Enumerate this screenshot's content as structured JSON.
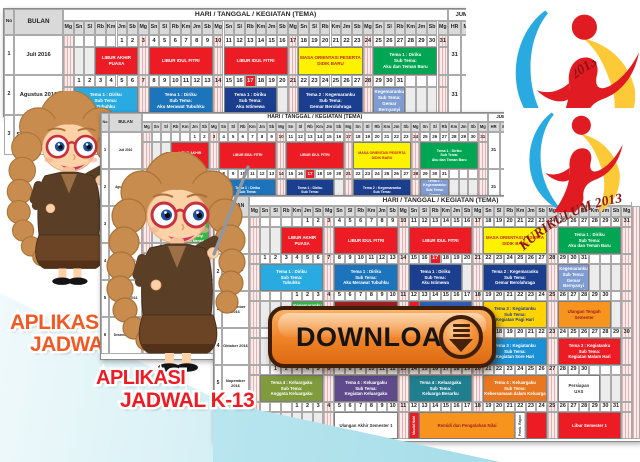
{
  "calendar": {
    "no_label": "No",
    "bulan_label": "BULAN",
    "title": "HARI / TANGGAL / KEGIATAN (TEMA)",
    "jumlah_label": "JUMLAH",
    "jumlah_cols": [
      "HR",
      "MG",
      "HE"
    ],
    "days": [
      "Mg",
      "Sn",
      "Sl",
      "Rb",
      "Km",
      "Jm",
      "Sb"
    ],
    "months": [
      {
        "no": "1",
        "name": "Juli 2016",
        "start_col": 6,
        "days": 31,
        "hr": "31",
        "mg": "5",
        "holiday_cols": [],
        "events": [
          {
            "c0": 4,
            "c1": 7,
            "bg": "#ed1c24",
            "fg": "#ffffff",
            "lines": [
              "LIBUR AKHIR",
              "PUASA"
            ]
          },
          {
            "c0": 9,
            "c1": 14,
            "bg": "#ed1c24",
            "fg": "#ffffff",
            "lines": [
              "LIBUR IDUL FITRI"
            ]
          },
          {
            "c0": 16,
            "c1": 21,
            "bg": "#ed1c24",
            "fg": "#ffffff",
            "lines": [
              "LIBUR IDUL FITRI"
            ]
          },
          {
            "c0": 23,
            "c1": 28,
            "bg": "#fff200",
            "fg": "#c1272d",
            "lines": [
              "MASA ORIENTASI PESERTA",
              "DIDIK BARU"
            ]
          },
          {
            "c0": 30,
            "c1": 35,
            "bg": "#00a651",
            "fg": "#ffffff",
            "lines": [
              "Tema 1 : Diriku",
              "Sub Tema:",
              "Aku dan Teman Baru"
            ]
          }
        ]
      },
      {
        "no": "2",
        "name": "Agustus 2016",
        "start_col": 2,
        "days": 31,
        "hr": "31",
        "mg": "4",
        "holiday_cols": [
          18
        ],
        "events": [
          {
            "c0": 2,
            "c1": 7,
            "bg": "#29abe2",
            "fg": "#ffffff",
            "lines": [
              "Tema 1 : Diriku",
              "Sub Tema:",
              "Tubuhku"
            ]
          },
          {
            "c0": 9,
            "c1": 14,
            "bg": "#1c75bc",
            "fg": "#ffffff",
            "lines": [
              "Tema 1 : Diriku",
              "Sub Tema:",
              "Aku Merawat Tubuhku"
            ]
          },
          {
            "c0": 16,
            "c1": 20,
            "bg": "#1b3e8f",
            "fg": "#ffffff",
            "lines": [
              "Tema 1 : Diriku",
              "Sub Tema:",
              "Aku Istimewa"
            ]
          },
          {
            "c0": 23,
            "c1": 28,
            "bg": "#1b3e8f",
            "fg": "#ffffff",
            "lines": [
              "Tema 2 : Kegemaranku",
              "Sub Tema:",
              "Gemar Berolahraga"
            ]
          },
          {
            "c0": 30,
            "c1": 32,
            "bg": "#7e9cd1",
            "fg": "#ffffff",
            "lines": [
              "Tema 2 :",
              "Kegemaranku",
              "Sub Tema:",
              "Gemar Bernyanyi",
              "dan Menari"
            ]
          }
        ]
      },
      {
        "no": "3",
        "name": "September 2016",
        "start_col": 5,
        "days": 30,
        "hr": "30",
        "mg": "4",
        "holiday_cols": [],
        "events": [
          {
            "c0": 5,
            "c1": 7,
            "bg": "#39b54a",
            "fg": "#ffffff",
            "lines": [
              "Tema 2 :",
              "Kegemaranku",
              "Sub Tema:",
              "Gemar Bernyanyi",
              "dan Menari"
            ]
          },
          {
            "c0": 9,
            "c1": 14,
            "bg": "#9e1f20",
            "fg": "#ffffff",
            "lines": [
              "Tema 2 : Kegemaranku",
              "Sub Tema:",
              "Gemar Menggambar"
            ]
          },
          {
            "c0": 16,
            "c1": 16,
            "bg": "#ed1c24",
            "fg": "#ffffff",
            "vertical": true,
            "lines": [
              "Idul Adha"
            ]
          },
          {
            "c0": 17,
            "c1": 21,
            "bg": "#2e5fb7",
            "fg": "#ffffff",
            "lines": [
              "Tema 2 : Kegemaranku",
              "Sub Tema:",
              "Gemar Membaca"
            ]
          },
          {
            "c0": 23,
            "c1": 28,
            "bg": "#ffd200",
            "fg": "#1b3e8f",
            "lines": [
              "Tema 3 : Kegiatanku",
              "Sub Tema:",
              "Kegiatan Pagi Hari"
            ]
          },
          {
            "c0": 30,
            "c1": 34,
            "bg": "#f7941e",
            "fg": "#9e1f20",
            "lines": [
              "Ulangan Tengah",
              "Semester"
            ]
          }
        ]
      },
      {
        "no": "4",
        "name": "Oktober 2016",
        "start_col": 7,
        "days": 31,
        "hr": "31",
        "mg": "5",
        "holiday_cols": [],
        "events": [
          {
            "c0": 9,
            "c1": 14,
            "bg": "#f7941e",
            "fg": "#ffffff",
            "lines": [
              "Tema 3 : Kegiatanku",
              "Sub Tema:",
              "Kegiatan Siang Hari"
            ]
          },
          {
            "c0": 23,
            "c1": 28,
            "bg": "#1c90d4",
            "fg": "#ffffff",
            "lines": [
              "Tema 3 : Kegiatanku",
              "Sub Tema:",
              "Kegiatan Sore Hari"
            ]
          },
          {
            "c0": 30,
            "c1": 35,
            "bg": "#ed1c24",
            "fg": "#ffffff",
            "lines": [
              "Tema 3 : Kegiatanku",
              "Sub Tema:",
              "Kegiatan Malam Hari"
            ]
          }
        ]
      },
      {
        "no": "5",
        "name": "Nopember 2016",
        "start_col": 3,
        "days": 30,
        "hr": "30",
        "mg": "4",
        "holiday_cols": [],
        "events": [
          {
            "c0": 2,
            "c1": 7,
            "bg": "#7f9b3c",
            "fg": "#ffffff",
            "lines": [
              "Tema 4 : Keluargaku",
              "Sub Tema:",
              "Anggota Keluargaku"
            ]
          },
          {
            "c0": 9,
            "c1": 14,
            "bg": "#5f4b8b",
            "fg": "#ffffff",
            "lines": [
              "Tema 4 : Keluargaku",
              "Sub Tema:",
              "Kegiatan Keluargaku"
            ]
          },
          {
            "c0": 16,
            "c1": 21,
            "bg": "#1f7f8f",
            "fg": "#ffffff",
            "lines": [
              "Tema 4 : Keluargaku",
              "Sub Tema:",
              "Keluarga Besarku"
            ]
          },
          {
            "c0": 23,
            "c1": 28,
            "bg": "#e87722",
            "fg": "#ffffff",
            "lines": [
              "Tema 4 : Keluargaku",
              "Sub Tema:",
              "Kebersamaan dalam Keluarga"
            ]
          },
          {
            "c0": 30,
            "c1": 33,
            "bg": "#ffffff",
            "fg": "#333333",
            "lines": [
              "Persiapan",
              "UAS"
            ]
          }
        ]
      },
      {
        "no": "6",
        "name": "Desember 2016",
        "start_col": 5,
        "days": 31,
        "hr": "31",
        "mg": "4",
        "holiday_cols": [],
        "events": [
          {
            "c0": 9,
            "c1": 14,
            "bg": "#ffffff",
            "fg": "#333333",
            "lines": [
              "Ulangan Akhir Semester 1"
            ]
          },
          {
            "c0": 16,
            "c1": 16,
            "bg": "#ed1c24",
            "fg": "#ffffff",
            "vertical": true,
            "lines": [
              "Maulid Nabi"
            ]
          },
          {
            "c0": 17,
            "c1": 25,
            "bg": "#f7941e",
            "fg": "#9e1f20",
            "lines": [
              "Remidi dan Pengolahan Nilai"
            ]
          },
          {
            "c0": 26,
            "c1": 26,
            "bg": "#ffffff",
            "fg": "#333333",
            "vertical": true,
            "lines": [
              "Pemb. Rapor"
            ]
          },
          {
            "c0": 27,
            "c1": 28,
            "bg": "#ed1c24",
            "fg": "#ffffff",
            "lines": [
              ""
            ]
          },
          {
            "c0": 30,
            "c1": 35,
            "bg": "#ed1c24",
            "fg": "#ffffff",
            "lines": [
              "Libur Semester 1"
            ]
          }
        ]
      }
    ]
  },
  "titles": {
    "back_line1": "APLIKASI",
    "back_line2": "JADWAL",
    "back_color": "#f15a24",
    "front_line1": "APLIKASI",
    "front_line2": "JADWAL K-13",
    "front_color": "#ed1c24"
  },
  "download": {
    "label": "DOWNLOAD",
    "button_color": "#f08428",
    "border_color": "#3f1f08"
  },
  "logo": {
    "arc_text": "KURIKULUM 2013",
    "arc_color": "#8b1413",
    "blue": "#29abe2",
    "yellow": "#fdc936",
    "red": "#e01b22"
  },
  "teacher": {
    "hair": "#c88c4e",
    "skin": "#fcd2a6",
    "glasses": "#c9303e",
    "jacket": "#5a3f26",
    "shirt": "#9c6f45",
    "skirt": "#6b4426"
  },
  "background": {
    "wedge_light": "#cdedf3",
    "wedge_deep": "#9bd9e6"
  }
}
